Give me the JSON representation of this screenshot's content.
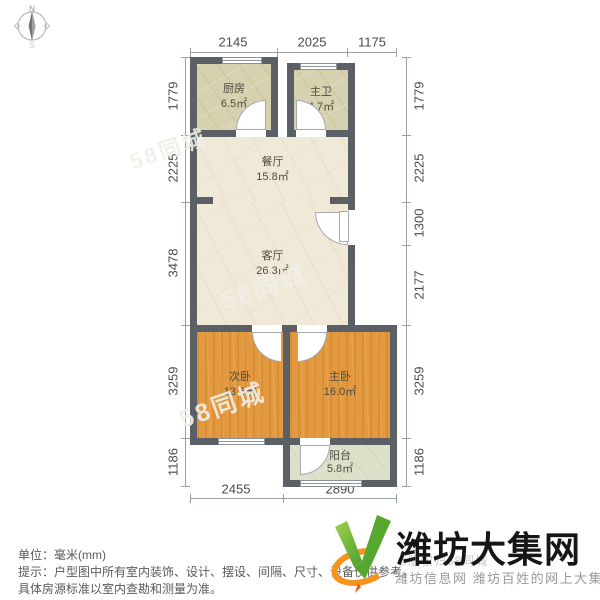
{
  "compass": {
    "north": "N",
    "south": "S"
  },
  "dimensions": {
    "top": [
      "2145",
      "2025",
      "1175"
    ],
    "bottom": [
      "2455",
      "2890"
    ],
    "left": [
      "1779",
      "2225",
      "3478",
      "3259",
      "1186"
    ],
    "right": [
      "1779",
      "2225",
      "1300",
      "2177",
      "3259",
      "1186"
    ]
  },
  "rooms": {
    "kitchen": {
      "name": "厨房",
      "area": "6.5㎡"
    },
    "bath": {
      "name": "主卫",
      "area": "4.7㎡"
    },
    "dining": {
      "name": "餐厅",
      "area": "15.8㎡"
    },
    "living": {
      "name": "客厅",
      "area": "26.3㎡"
    },
    "bedroom2": {
      "name": "次卧",
      "area": "13.6㎡"
    },
    "bedroom1": {
      "name": "主卧",
      "area": "16.0㎡"
    },
    "balcony": {
      "name": "阳台",
      "area": "5.8㎡"
    }
  },
  "watermark": {
    "text": "58同城"
  },
  "footer": {
    "unit_line": "单位：毫米(mm)",
    "tip_line1": "提示：户型图中所有室内装饰、设计、摆设、间隔、尺寸、设备仅供参考，",
    "tip_line2": "具体房源标准以室内查勘和测量为准。"
  },
  "logo": {
    "title": "潍坊大集网",
    "subtitle": "潍坊信息网 潍坊百姓的网上大集",
    "copyright_watermark": "©版权归58同城"
  },
  "colors": {
    "wall": "#5b6067",
    "hall_fill": "#f0e9d8",
    "kitchen_fill": "#d6d2b0",
    "bedroom_fill": "#e2993f",
    "balcony_fill": "#dde1ca",
    "logo_green": "#6fb435",
    "logo_orange": "#f7941d"
  }
}
